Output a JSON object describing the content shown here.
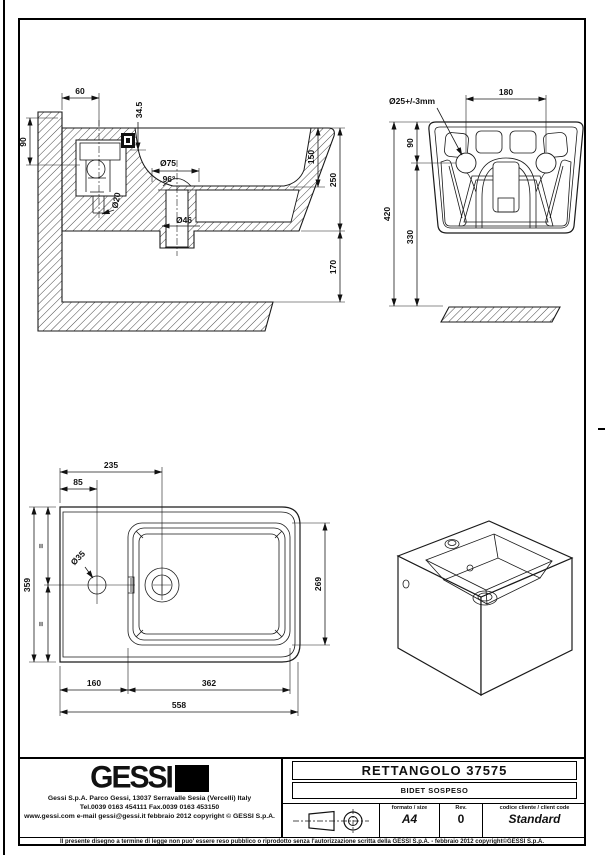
{
  "section": {
    "dims": {
      "d60": "60",
      "d345": "34.5",
      "d90": "90",
      "d20": "Ø20",
      "d75": "Ø75",
      "a96": "96°",
      "d46": "Ø46",
      "d150": "150",
      "d250": "250",
      "d170": "170"
    }
  },
  "rear": {
    "dims": {
      "d25": "Ø25+/-3mm",
      "d180": "180",
      "d90": "90",
      "d420": "420",
      "d330": "330"
    }
  },
  "plan": {
    "dims": {
      "d235": "235",
      "d85": "85",
      "d35": "Ø35",
      "d359": "359",
      "d269": "269",
      "d160": "160",
      "d362": "362",
      "d558": "558",
      "eq1": "=",
      "eq2": "="
    }
  },
  "title_block": {
    "logo_text": "GESSI",
    "address_line1": "Gessi  S.p.A.  Parco  Gessi,  13037  Serravalle  Sesia  (Vercelli)  Italy",
    "address_line2": "Tel.0039  0163  454111   Fax.0039  0163  453150",
    "address_line3": "www.gessi.com  e-mail  gessi@gessi.it    febbraio  2012    copyright © GESSI  S.p.A.",
    "product_title": "RETTANGOLO  37575",
    "product_subtitle": "BIDET SOSPESO",
    "format_label": "formato  /  size",
    "format_value": "A4",
    "rev_label": "Rev.",
    "rev_value": "0",
    "client_code_label": "codice cliente / client code",
    "client_code_value": "Standard"
  },
  "footer": {
    "disclaimer": "Il presente disegno a termine di legge non puo' essere reso pubblico o riprodotto senza l'autorizzazione scritta della GESSI S.p.A.  -  febbraio 2012  copyright©GESSI S.p.A."
  }
}
